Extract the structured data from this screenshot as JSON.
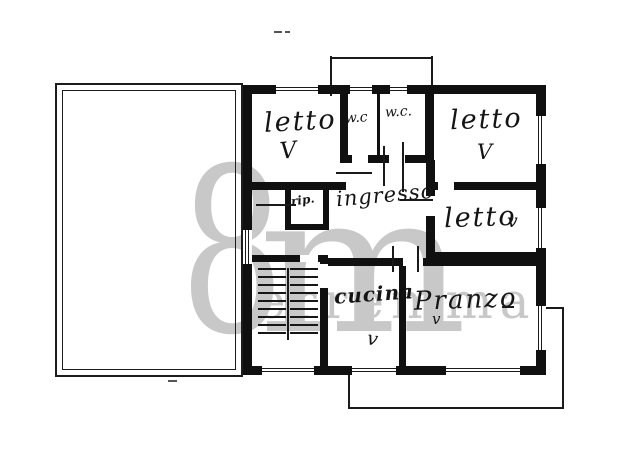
{
  "document": {
    "type": "hand-drawn floor plan"
  },
  "rooms": [
    {
      "name": "bedroom-top-left",
      "label": "letto",
      "mark": "V"
    },
    {
      "name": "wc-small",
      "label": "w.c",
      "mark": ""
    },
    {
      "name": "wc-large",
      "label": "w.c.",
      "mark": ""
    },
    {
      "name": "bedroom-top-right",
      "label": "letto",
      "mark": "V"
    },
    {
      "name": "bedroom-mid-right",
      "label": "letto",
      "mark": "v"
    },
    {
      "name": "entrance-hall",
      "label": "ingresso",
      "mark": ""
    },
    {
      "name": "storage-closet",
      "label": "rip.",
      "mark": ""
    },
    {
      "name": "kitchen",
      "label": "cucina",
      "mark": "v"
    },
    {
      "name": "dining-room",
      "label": "Pranzo",
      "mark": "v"
    }
  ],
  "watermark": {
    "glyph_8": "8",
    "glyph_m": "m",
    "text": "erremma"
  },
  "colors": {
    "ink": "#141414",
    "wall": "#101010",
    "paper": "#ffffff",
    "watermark": "#c8c8c8"
  }
}
